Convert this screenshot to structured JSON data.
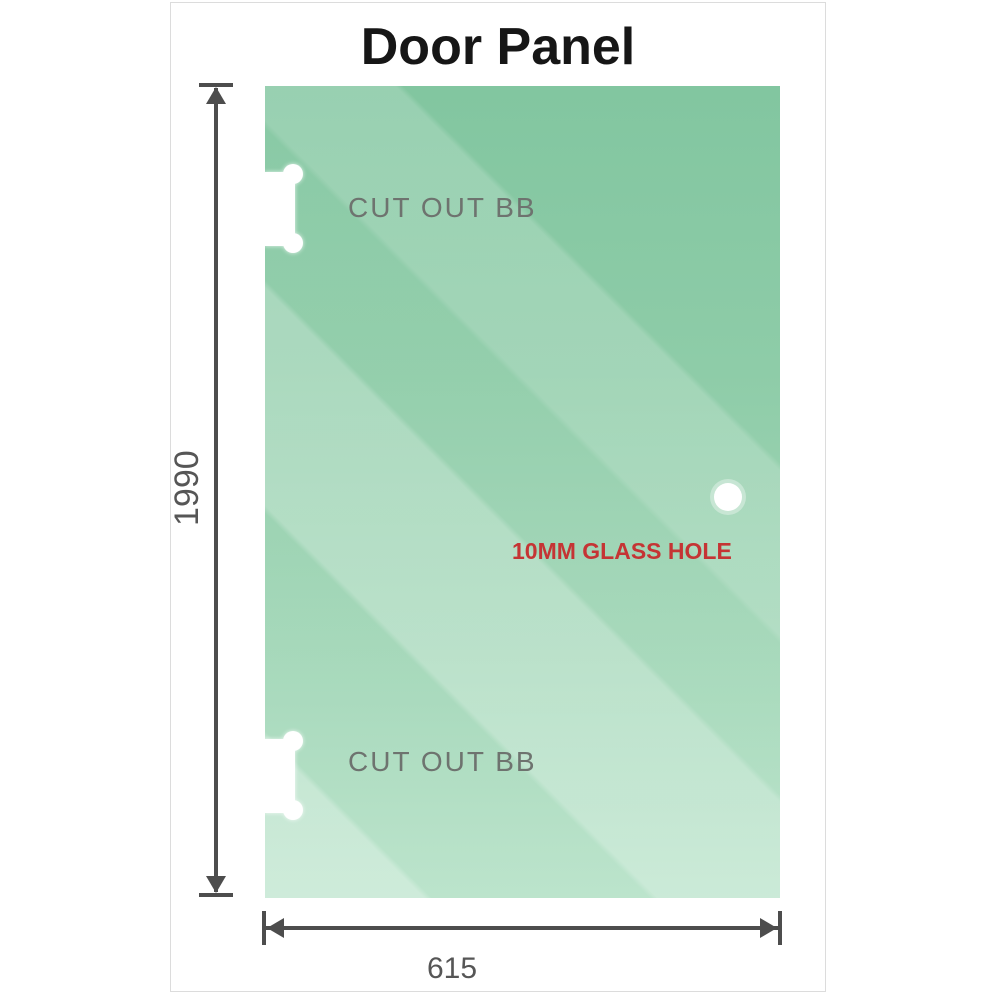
{
  "title": "Door Panel",
  "glass_panel": {
    "cutouts": [
      {
        "label": "CUT OUT BB",
        "position": "top-left-edge"
      },
      {
        "label": "CUT OUT BB",
        "position": "bottom-left-edge"
      }
    ],
    "hole": {
      "label": "10MM GLASS HOLE",
      "position": "right-middle"
    }
  },
  "dimensions": {
    "height": {
      "value": "1990",
      "orientation": "vertical-left"
    },
    "width": {
      "value": "615",
      "orientation": "horizontal-bottom"
    }
  },
  "colors": {
    "glass_base": "#8ecca8",
    "glass_light": "#b9e3ca",
    "annotation_red": "#c53434",
    "label_gray": "#6e736f",
    "dimension_gray": "#4d4d4d",
    "title_black": "#161616",
    "card_border": "#dcdcdc"
  }
}
